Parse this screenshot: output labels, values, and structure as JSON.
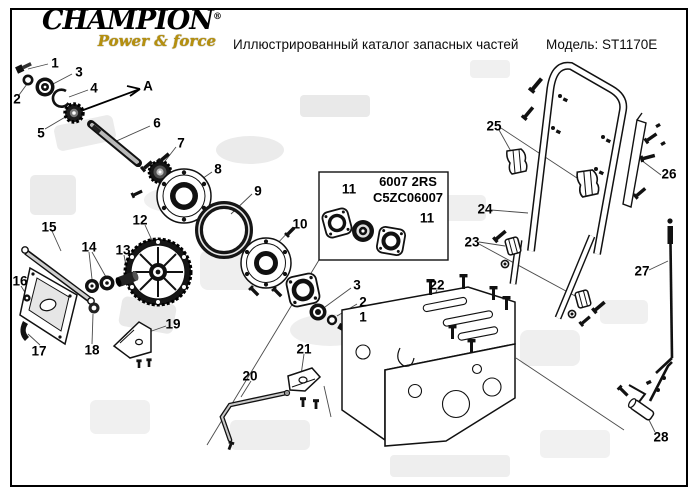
{
  "header": {
    "logo": {
      "brand": "CHAMPION",
      "reg": "®",
      "tagline": "Power & force"
    },
    "title": "Иллюстрированный каталог запасных частей",
    "model_label": "Модель: ST1170E"
  },
  "diagram": {
    "inset_box": {
      "line1": "6007 2RS",
      "line2": "C5ZC06007"
    },
    "view_arrow_label": "A",
    "callouts": [
      {
        "label": "1",
        "x": 55,
        "y": 63
      },
      {
        "label": "2",
        "x": 17,
        "y": 99
      },
      {
        "label": "3",
        "x": 79,
        "y": 72
      },
      {
        "label": "4",
        "x": 94,
        "y": 88
      },
      {
        "label": "5",
        "x": 41,
        "y": 133
      },
      {
        "label": "6",
        "x": 157,
        "y": 123
      },
      {
        "label": "7",
        "x": 181,
        "y": 143
      },
      {
        "label": "8",
        "x": 218,
        "y": 169
      },
      {
        "label": "9",
        "x": 258,
        "y": 191
      },
      {
        "label": "10",
        "x": 300,
        "y": 224
      },
      {
        "label": "11",
        "x": 349,
        "y": 189
      },
      {
        "label": "11",
        "x": 427,
        "y": 218
      },
      {
        "label": "12",
        "x": 140,
        "y": 220
      },
      {
        "label": "13",
        "x": 123,
        "y": 250
      },
      {
        "label": "14",
        "x": 89,
        "y": 247
      },
      {
        "label": "15",
        "x": 49,
        "y": 227
      },
      {
        "label": "16",
        "x": 20,
        "y": 281
      },
      {
        "label": "17",
        "x": 39,
        "y": 351
      },
      {
        "label": "18",
        "x": 92,
        "y": 350
      },
      {
        "label": "19",
        "x": 173,
        "y": 324
      },
      {
        "label": "20",
        "x": 250,
        "y": 376
      },
      {
        "label": "21",
        "x": 304,
        "y": 349
      },
      {
        "label": "22",
        "x": 437,
        "y": 285
      },
      {
        "label": "23",
        "x": 472,
        "y": 242
      },
      {
        "label": "24",
        "x": 485,
        "y": 209
      },
      {
        "label": "25",
        "x": 494,
        "y": 126
      },
      {
        "label": "26",
        "x": 669,
        "y": 174
      },
      {
        "label": "27",
        "x": 642,
        "y": 271
      },
      {
        "label": "28",
        "x": 661,
        "y": 437
      },
      {
        "label": "3",
        "x": 357,
        "y": 285
      },
      {
        "label": "2",
        "x": 363,
        "y": 302
      },
      {
        "label": "1",
        "x": 363,
        "y": 317
      },
      {
        "label": "A",
        "x": 148,
        "y": 86
      }
    ]
  },
  "colors": {
    "brand_gold": "#b6900e",
    "line_black": "#000000",
    "background": "#ffffff",
    "watermark_gray": "#ebebeb"
  }
}
